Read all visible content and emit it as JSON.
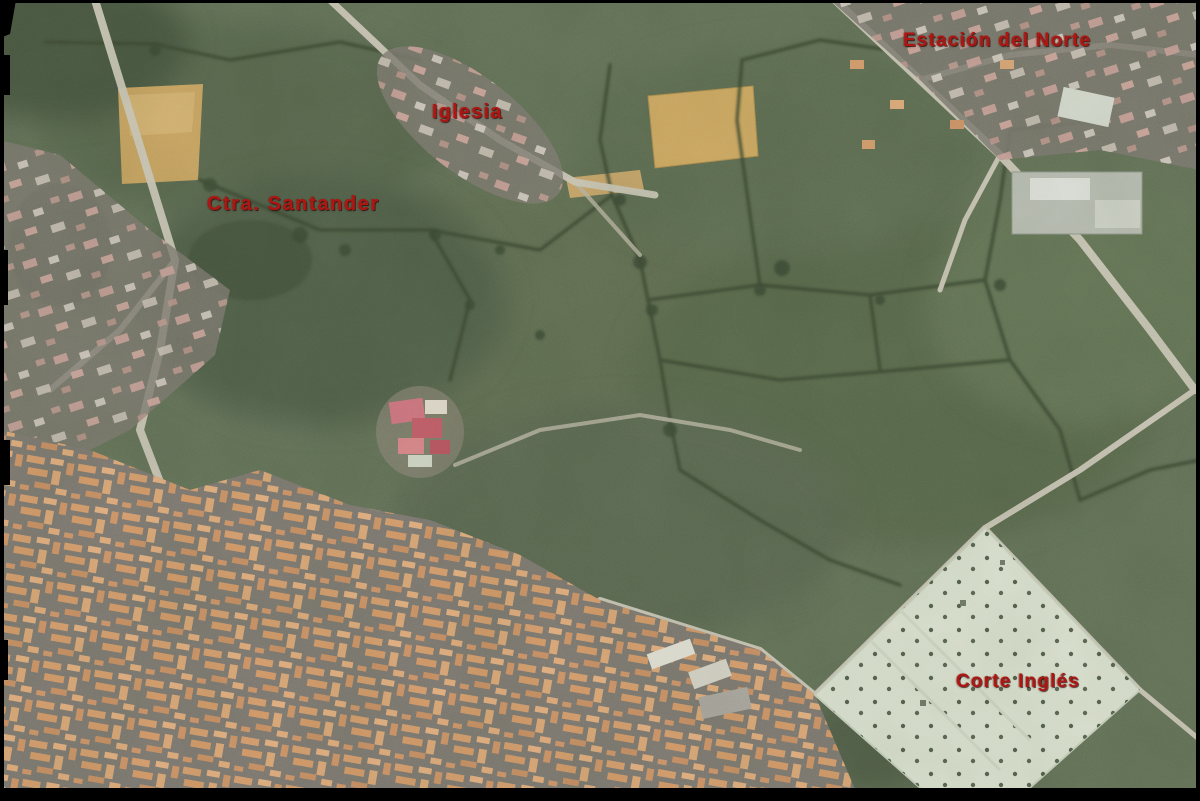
{
  "image": {
    "kind": "aerial-orthophoto",
    "description": "Aerial photograph of a town edge: hedgerow-divided green pastures across the upper half, tan ploughed fields, a dense orange-roofed urban grid in the lower left, and a large light commercial site with dotted parking in the lower right, framed by a black border."
  },
  "labels": [
    {
      "name": "station",
      "text": "Estación del Norte"
    },
    {
      "name": "church",
      "text": "Iglesia"
    },
    {
      "name": "road",
      "text": "Ctra. Santander"
    },
    {
      "name": "store",
      "text": "Corte Inglés"
    }
  ],
  "palette": {
    "label_red": "#ad1612",
    "field_green": "#5f6d55",
    "hedgerow_dark": "#39442f",
    "ploughed_tan": "#c9a15e",
    "road_light": "#cfc9bb",
    "urban_base_gray": "#79746e",
    "urban_roof_orange": "#d89a6a",
    "commercial_site_light": "#dde4d2",
    "frame_black": "#000000"
  }
}
